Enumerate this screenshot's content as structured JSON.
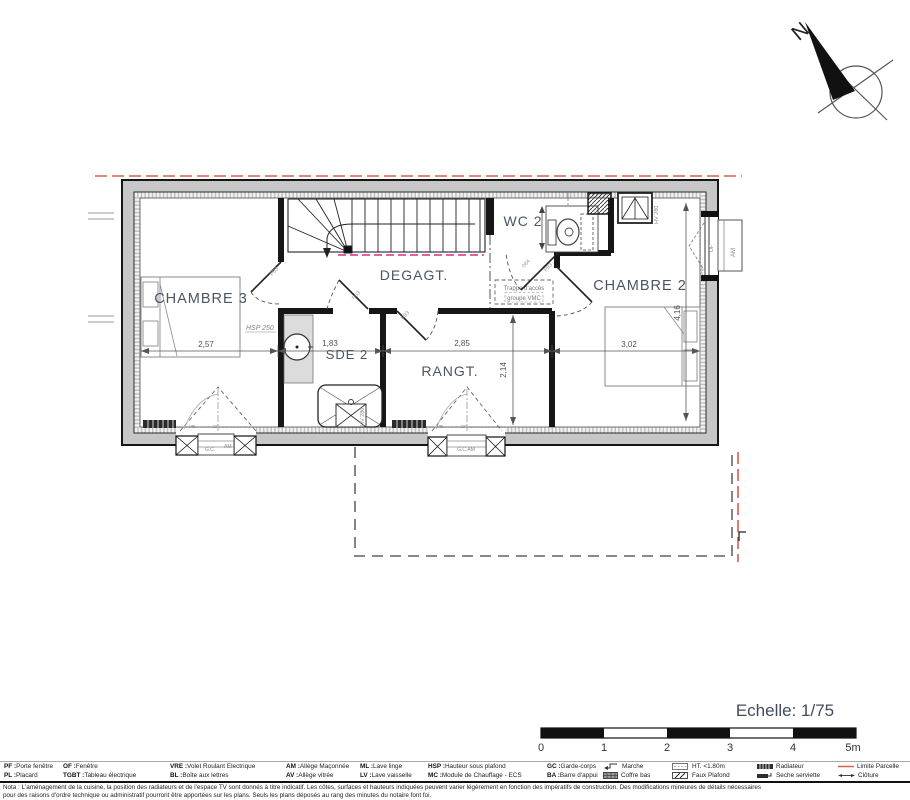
{
  "compass": {
    "north": "N"
  },
  "scale": {
    "label": "Echelle: 1/75",
    "ticks": [
      "0",
      "1",
      "2",
      "3",
      "4",
      "5m"
    ]
  },
  "rooms": {
    "chambre3": "CHAMBRE 3",
    "degagt": "DEGAGT.",
    "wc2": "WC 2",
    "chambre2": "CHAMBRE 2",
    "sde2": "SDE 2",
    "rangt": "RANGT."
  },
  "dims": {
    "ch3_w": "2,57",
    "sde2_w": "1,83",
    "rangt_w": "2,85",
    "ch2_w": "3,02",
    "rangt_d": "2,14",
    "ch2_d": "4,16"
  },
  "ann": {
    "hsp": "HSP 250",
    "trappe1": "Trappe d'accès",
    "trappe2": "groupe VMC",
    "hv_douche": "HV 280",
    "hv_velux": "HV 280",
    "door_a": "P63",
    "door_b": "P63",
    "door_c": "P83",
    "door_d": "084",
    "door_e": "P83",
    "w1_gc": "G.C.",
    "w1_am": "AM",
    "w1_vr": "VR",
    "w1_cf": "CF",
    "w2_gcam": "G.C.AM",
    "w2_vr": "VR",
    "w2_cf": "CF",
    "we_am": "AM",
    "we_of": "OF",
    "we_vre": "VRE"
  },
  "legend": {
    "row1": [
      {
        "abbr": "PF",
        "label": "Porte fenêtre"
      },
      {
        "abbr": "OF",
        "label": "Fenêtre"
      },
      {
        "abbr": "VRE",
        "label": "Volet Roulant Electrique"
      },
      {
        "abbr": "AM",
        "label": "Allège Maçonnée"
      },
      {
        "abbr": "ML",
        "label": "Lave linge"
      },
      {
        "abbr": "HSP",
        "label": "Hauteur sous plafond"
      },
      {
        "abbr": "GC",
        "label": "Garde-corps"
      },
      {
        "icon": "marche-icon",
        "label": "Marche"
      },
      {
        "icon": "ht-icon",
        "label": "HT. <1.80m"
      },
      {
        "icon": "radiateur-icon",
        "label": "Radiateur"
      },
      {
        "icon": "limite-parcelle-icon",
        "label": "Limite Parcelle"
      }
    ],
    "row2": [
      {
        "abbr": "PL",
        "label": "Placard"
      },
      {
        "abbr": "TGBT",
        "label": "Tableau électrique"
      },
      {
        "abbr": "BL",
        "label": "Boîte aux lettres"
      },
      {
        "abbr": "AV",
        "label": "Allège vitrée"
      },
      {
        "abbr": "LV",
        "label": "Lave vaisselle"
      },
      {
        "abbr": "MC",
        "label": "Module de Chauffage - ECS"
      },
      {
        "abbr": "BA",
        "label": "Barre d'appui"
      },
      {
        "icon": "coffre-bas-icon",
        "label": "Coffre bas"
      },
      {
        "icon": "faux-plafond-icon",
        "label": "Faux Plafond"
      },
      {
        "icon": "seche-serviette-icon",
        "label": "Seche serviette"
      },
      {
        "icon": "cloture-icon",
        "label": "Clôture"
      }
    ]
  },
  "nota": {
    "line1": "Nota : L'aménagement de la cuisine, la position des radiateurs et de l'espace TV sont donnés à titre indicatif. Les côtes, surfaces et hauteurs indiquées peuvent varier légèrement en fonction des impératifs de construction. Des modifications mineures de détails nécessaires",
    "line2": "pour des raisons d'ordre technique ou administratif pourront être apportées sur les plans. Seuls les plans déposés au rang des minutes du notaire font foi."
  }
}
